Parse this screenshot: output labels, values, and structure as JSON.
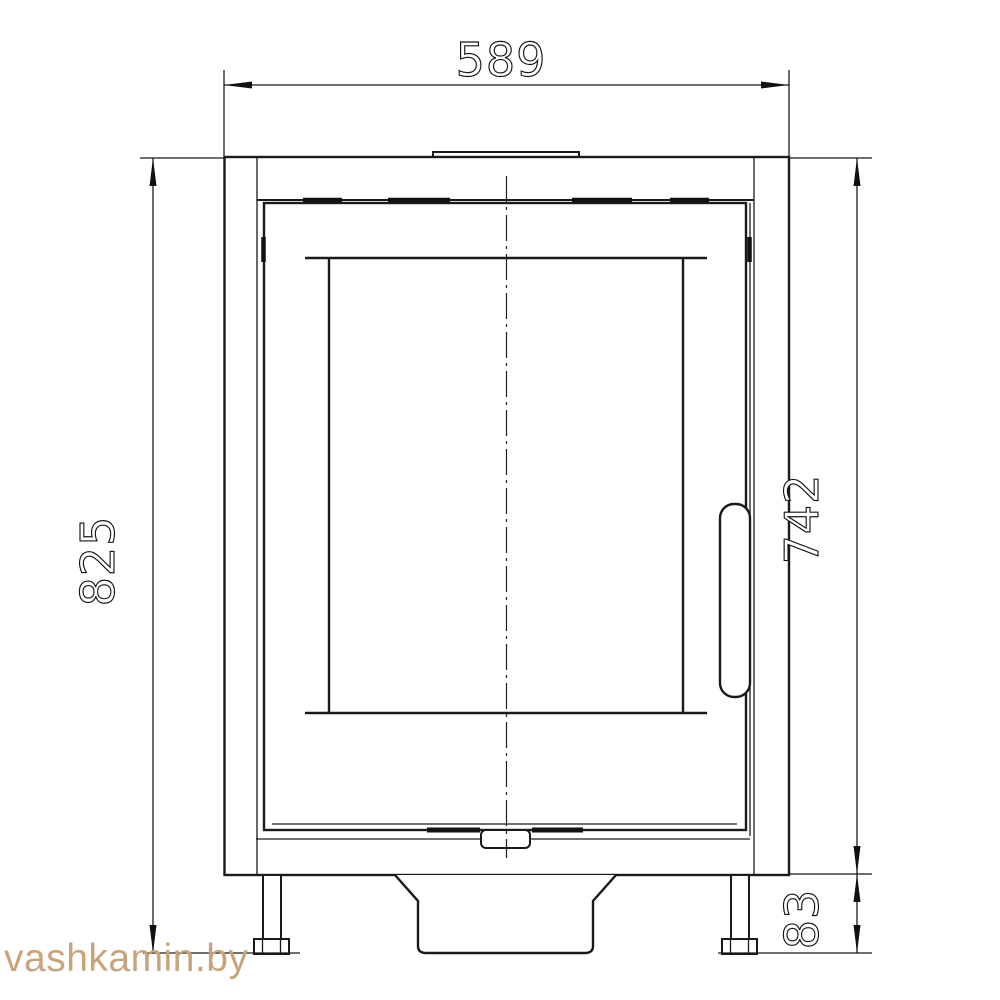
{
  "page": {
    "background": "#ffffff",
    "line_color": "#1a1a1a"
  },
  "drawing": {
    "type": "technical-front-elevation",
    "subject": "stove-front-view",
    "dimensions": {
      "overall_width": "589",
      "overall_height": "825",
      "body_height": "742",
      "base_height": "83"
    },
    "watermark": {
      "text": "vashkamin.by",
      "color": "#c8a47c"
    }
  }
}
